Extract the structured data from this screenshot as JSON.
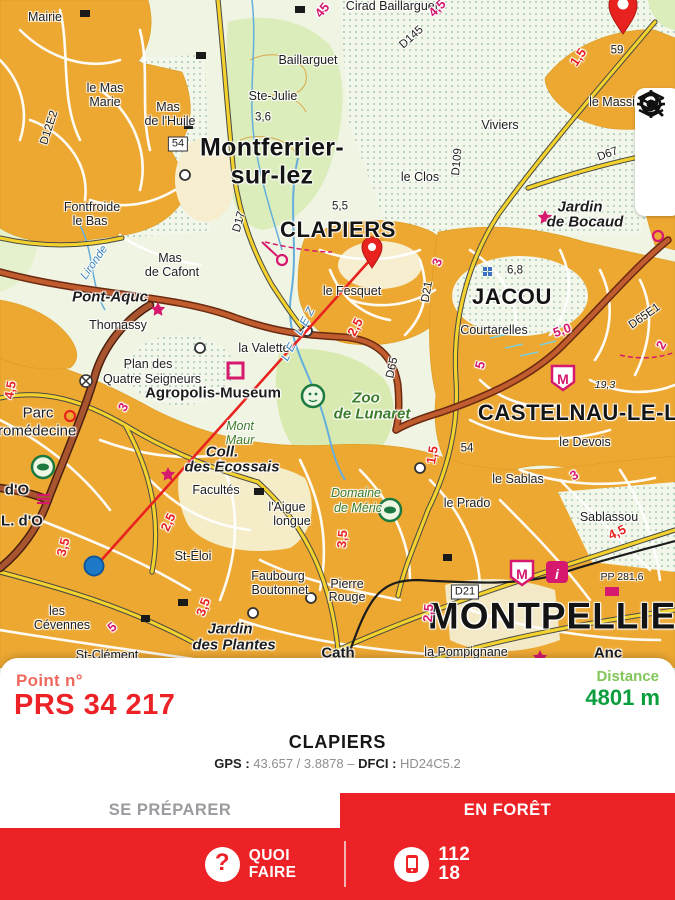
{
  "panel": {
    "point_label": "Point n°",
    "point_value": "PRS 34 217",
    "distance_label": "Distance",
    "distance_value": "4801 m",
    "place": "CLAPIERS",
    "gps_label": "GPS :",
    "gps_value": "43.657 / 3.8878",
    "separator": "–",
    "dfci_label": "DFCI :",
    "dfci_value": "HD24C5.2"
  },
  "tabs": {
    "prepare": "SE PRÉPARER",
    "forest": "EN FORÊT",
    "active": "forest"
  },
  "bottom_bar": {
    "question_mark": "?",
    "quoi_line1": "QUOI",
    "quoi_line2": "FAIRE",
    "num1": "112",
    "num2": "18"
  },
  "controls": {
    "icons": [
      "search-icon",
      "layers-icon",
      "locate-icon"
    ]
  },
  "colors": {
    "primary_red": "#EC2227",
    "point_label_red": "#EF6A5E",
    "distance_light_green": "#82C65A",
    "distance_dark_green": "#0B9E3D",
    "inactive_tab_gray": "#9B9BA0",
    "route_line_red": "#E8231F",
    "location_blue": "#1E78C8"
  },
  "map": {
    "labels": [
      {
        "t": "Mairie",
        "x": 45,
        "y": 17,
        "c": "p"
      },
      {
        "t": "Cirad Baillarguet",
        "x": 392,
        "y": 6,
        "c": "p"
      },
      {
        "t": "Baillarguet",
        "x": 308,
        "y": 60,
        "c": "p"
      },
      {
        "t": "Ste-Julie",
        "x": 273,
        "y": 96,
        "c": "p"
      },
      {
        "t": "3,6",
        "x": 263,
        "y": 118,
        "c": "s"
      },
      {
        "t": "le Mas",
        "x": 105,
        "y": 88,
        "c": "p"
      },
      {
        "t": "Marie",
        "x": 105,
        "y": 102,
        "c": "p"
      },
      {
        "t": "Mas",
        "x": 168,
        "y": 107,
        "c": "p"
      },
      {
        "t": "de l'Huile",
        "x": 170,
        "y": 121,
        "c": "p"
      },
      {
        "t": "D12E2",
        "x": 50,
        "y": 128,
        "c": "s",
        "r": -72
      },
      {
        "t": "54",
        "x": 178,
        "y": 144,
        "c": "badge"
      },
      {
        "t": "Montferrier-",
        "x": 272,
        "y": 148,
        "c": "big"
      },
      {
        "t": "sur-lez",
        "x": 272,
        "y": 176,
        "c": "big"
      },
      {
        "t": "D17",
        "x": 240,
        "y": 222,
        "c": "s",
        "r": -75
      },
      {
        "t": "5,5",
        "x": 340,
        "y": 207,
        "c": "s"
      },
      {
        "t": "CLAPIERS",
        "x": 338,
        "y": 230,
        "c": "city"
      },
      {
        "t": "le Fesquet",
        "x": 352,
        "y": 291,
        "c": "p"
      },
      {
        "t": "Fontfroide",
        "x": 92,
        "y": 207,
        "c": "p"
      },
      {
        "t": "le Bas",
        "x": 90,
        "y": 221,
        "c": "p"
      },
      {
        "t": "Mas",
        "x": 170,
        "y": 258,
        "c": "p"
      },
      {
        "t": "de Cafont",
        "x": 172,
        "y": 272,
        "c": "p"
      },
      {
        "t": "Lironde",
        "x": 95,
        "y": 263,
        "c": "s i bl",
        "r": -55
      },
      {
        "t": "Pont-Aquc",
        "x": 110,
        "y": 297,
        "c": "f15 b i"
      },
      {
        "t": "Thomassy",
        "x": 118,
        "y": 325,
        "c": "p"
      },
      {
        "t": "la Valette",
        "x": 264,
        "y": 348,
        "c": "p"
      },
      {
        "t": "LE LEZ",
        "x": 300,
        "y": 333,
        "c": "s i bl sp",
        "r": -62
      },
      {
        "t": "D65",
        "x": 393,
        "y": 368,
        "c": "s",
        "r": -78
      },
      {
        "t": "Plan des",
        "x": 148,
        "y": 364,
        "c": "p"
      },
      {
        "t": "Quatre Seigneurs",
        "x": 152,
        "y": 379,
        "c": "p"
      },
      {
        "t": "Agropolis-Museum",
        "x": 213,
        "y": 393,
        "c": "f15 b"
      },
      {
        "t": "Zoo",
        "x": 366,
        "y": 398,
        "c": "f15 b i g"
      },
      {
        "t": "de Lunaret",
        "x": 372,
        "y": 414,
        "c": "f15 b i g"
      },
      {
        "t": "Mont",
        "x": 240,
        "y": 426,
        "c": "p i g"
      },
      {
        "t": "Maur",
        "x": 240,
        "y": 440,
        "c": "p i g"
      },
      {
        "t": "Coll.",
        "x": 222,
        "y": 452,
        "c": "f15 b i"
      },
      {
        "t": "des Ecossais",
        "x": 232,
        "y": 467,
        "c": "f15 b i"
      },
      {
        "t": "Facultés",
        "x": 216,
        "y": 490,
        "c": "p"
      },
      {
        "t": "St-Éloi",
        "x": 193,
        "y": 556,
        "c": "p"
      },
      {
        "t": "Parc",
        "x": 38,
        "y": 413,
        "c": "f15"
      },
      {
        "t": "Euromédecine",
        "x": 28,
        "y": 431,
        "c": "f15"
      },
      {
        "t": "d'O",
        "x": 17,
        "y": 490,
        "c": "f15 b"
      },
      {
        "t": "L. d'O",
        "x": 22,
        "y": 521,
        "c": "f15 b"
      },
      {
        "t": "les",
        "x": 57,
        "y": 611,
        "c": "p"
      },
      {
        "t": "Cévennes",
        "x": 62,
        "y": 625,
        "c": "p"
      },
      {
        "t": "St-Clément",
        "x": 107,
        "y": 655,
        "c": "p"
      },
      {
        "t": "Jardin",
        "x": 230,
        "y": 629,
        "c": "f15 b i"
      },
      {
        "t": "des Plantes",
        "x": 234,
        "y": 645,
        "c": "f15 b i"
      },
      {
        "t": "Faubourg",
        "x": 278,
        "y": 576,
        "c": "p"
      },
      {
        "t": "Boutonnet",
        "x": 280,
        "y": 590,
        "c": "p"
      },
      {
        "t": "Pierre",
        "x": 347,
        "y": 584,
        "c": "p"
      },
      {
        "t": "Rouge",
        "x": 347,
        "y": 597,
        "c": "p"
      },
      {
        "t": "l'Aigue",
        "x": 287,
        "y": 507,
        "c": "p"
      },
      {
        "t": "longue",
        "x": 292,
        "y": 521,
        "c": "p"
      },
      {
        "t": "Domaine",
        "x": 356,
        "y": 493,
        "c": "p i g"
      },
      {
        "t": "de Méric",
        "x": 358,
        "y": 508,
        "c": "p i g"
      },
      {
        "t": "le Devois",
        "x": 585,
        "y": 442,
        "c": "p"
      },
      {
        "t": "le Sablas",
        "x": 518,
        "y": 479,
        "c": "p"
      },
      {
        "t": "le Prado",
        "x": 467,
        "y": 503,
        "c": "p"
      },
      {
        "t": "Sablassou",
        "x": 609,
        "y": 517,
        "c": "p"
      },
      {
        "t": "Courtarelles",
        "x": 494,
        "y": 330,
        "c": "p"
      },
      {
        "t": "6,8",
        "x": 515,
        "y": 271,
        "c": "s"
      },
      {
        "t": "JACOU",
        "x": 512,
        "y": 297,
        "c": "city"
      },
      {
        "t": "D21",
        "x": 428,
        "y": 292,
        "c": "s",
        "r": -80
      },
      {
        "t": "D65E1",
        "x": 645,
        "y": 317,
        "c": "s",
        "r": -35
      },
      {
        "t": "19,3",
        "x": 605,
        "y": 385,
        "c": "t i"
      },
      {
        "t": "D67",
        "x": 608,
        "y": 155,
        "c": "s",
        "r": -20
      },
      {
        "t": "le Massi",
        "x": 612,
        "y": 102,
        "c": "p"
      },
      {
        "t": "59",
        "x": 617,
        "y": 51,
        "c": "s"
      },
      {
        "t": "D145",
        "x": 412,
        "y": 38,
        "c": "s",
        "r": -42
      },
      {
        "t": "Viviers",
        "x": 500,
        "y": 125,
        "c": "p"
      },
      {
        "t": "D109",
        "x": 458,
        "y": 162,
        "c": "s",
        "r": -85
      },
      {
        "t": "le Clos",
        "x": 420,
        "y": 177,
        "c": "p"
      },
      {
        "t": "Jardin",
        "x": 580,
        "y": 207,
        "c": "f15 b i"
      },
      {
        "t": "de Bocaud",
        "x": 585,
        "y": 222,
        "c": "f15 b i"
      },
      {
        "t": "D21",
        "x": 465,
        "y": 592,
        "c": "badge"
      },
      {
        "t": "MONTPELLIER",
        "x": 566,
        "y": 616,
        "c": "huge"
      },
      {
        "t": "la Pompignane",
        "x": 466,
        "y": 652,
        "c": "p"
      },
      {
        "t": "Anc",
        "x": 608,
        "y": 653,
        "c": "f15 b"
      },
      {
        "t": "Cath",
        "x": 338,
        "y": 653,
        "c": "f15 b"
      },
      {
        "t": "PP 281,6",
        "x": 622,
        "y": 577,
        "c": "t"
      },
      {
        "t": "54",
        "x": 467,
        "y": 449,
        "c": "s"
      },
      {
        "t": "CASTELNAU-LE-L",
        "x": 578,
        "y": 413,
        "c": "city"
      },
      {
        "t": "1,5",
        "x": 578,
        "y": 57,
        "c": "rn",
        "r": -55
      },
      {
        "t": "2,5",
        "x": 355,
        "y": 327,
        "c": "rn",
        "r": -62
      },
      {
        "t": "1,5",
        "x": 432,
        "y": 455,
        "c": "rn",
        "r": -80
      },
      {
        "t": "4,5",
        "x": 617,
        "y": 532,
        "c": "rn",
        "r": -25
      },
      {
        "t": "3,5",
        "x": 342,
        "y": 539,
        "c": "rn",
        "r": -85
      },
      {
        "t": "3,5",
        "x": 203,
        "y": 607,
        "c": "rn",
        "r": -70
      },
      {
        "t": "3,5",
        "x": 63,
        "y": 547,
        "c": "rn",
        "r": -75
      },
      {
        "t": "2,5",
        "x": 168,
        "y": 522,
        "c": "rn",
        "r": -65
      },
      {
        "t": "4,5",
        "x": 10,
        "y": 390,
        "c": "rn",
        "r": -80
      },
      {
        "t": "3",
        "x": 437,
        "y": 262,
        "c": "mn",
        "r": -70
      },
      {
        "t": "3",
        "x": 123,
        "y": 407,
        "c": "mn",
        "r": -60
      },
      {
        "t": "3",
        "x": 574,
        "y": 475,
        "c": "mn",
        "r": -30
      },
      {
        "t": "5,0",
        "x": 562,
        "y": 330,
        "c": "mn",
        "r": -20
      },
      {
        "t": "5",
        "x": 480,
        "y": 365,
        "c": "mn",
        "r": -75
      },
      {
        "t": "2,5",
        "x": 428,
        "y": 613,
        "c": "mn",
        "r": -85
      },
      {
        "t": "45",
        "x": 322,
        "y": 10,
        "c": "mn",
        "r": -50
      },
      {
        "t": "4,5",
        "x": 437,
        "y": 8,
        "c": "mn",
        "r": -45
      },
      {
        "t": "2",
        "x": 661,
        "y": 345,
        "c": "mn",
        "r": -60
      },
      {
        "t": "5",
        "x": 112,
        "y": 627,
        "c": "mn",
        "r": -40
      },
      {
        "t": "M",
        "x": 563,
        "y": 377,
        "c": "shield"
      },
      {
        "t": "M",
        "x": 522,
        "y": 572,
        "c": "shield"
      },
      {
        "t": "i",
        "x": 557,
        "y": 572,
        "c": "ibox"
      }
    ]
  }
}
